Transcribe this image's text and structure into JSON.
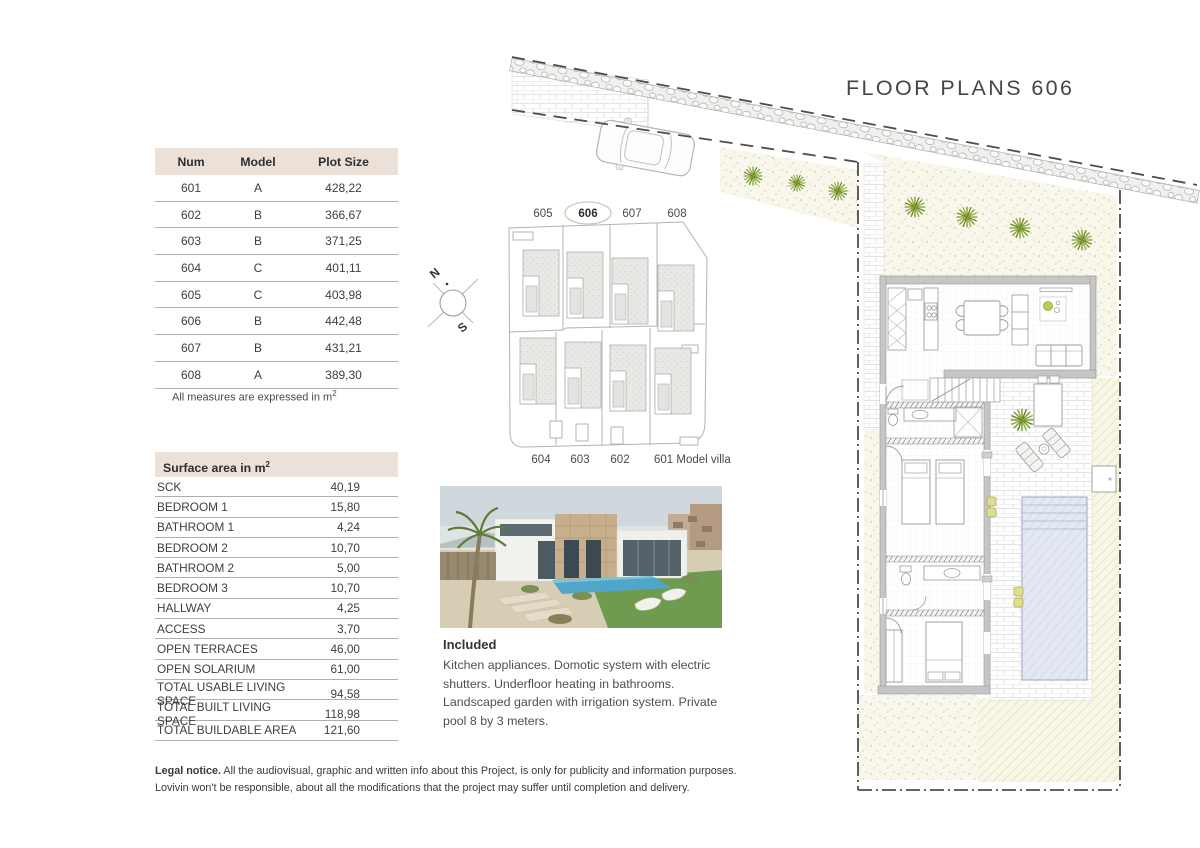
{
  "page": {
    "title": "FLOOR PLANS 606"
  },
  "plot_table": {
    "headers": [
      "Num",
      "Model",
      "Plot Size"
    ],
    "rows": [
      {
        "num": "601",
        "model": "A",
        "size": "428,22"
      },
      {
        "num": "602",
        "model": "B",
        "size": "366,67"
      },
      {
        "num": "603",
        "model": "B",
        "size": "371,25"
      },
      {
        "num": "604",
        "model": "C",
        "size": "401,11"
      },
      {
        "num": "605",
        "model": "C",
        "size": "403,98"
      },
      {
        "num": "606",
        "model": "B",
        "size": "442,48"
      },
      {
        "num": "607",
        "model": "B",
        "size": "431,21"
      },
      {
        "num": "608",
        "model": "A",
        "size": "389,30"
      }
    ],
    "note_text": "All measures are expressed in m",
    "note_sup": "2"
  },
  "surface_table": {
    "title_text": "Surface area in m",
    "title_sup": "2",
    "rows": [
      {
        "label": "SCK",
        "value": "40,19"
      },
      {
        "label": "BEDROOM 1",
        "value": "15,80"
      },
      {
        "label": "BATHROOM 1",
        "value": "4,24"
      },
      {
        "label": "BEDROOM 2",
        "value": "10,70"
      },
      {
        "label": "BATHROOM 2",
        "value": "5,00"
      },
      {
        "label": "BEDROOM 3",
        "value": "10,70"
      },
      {
        "label": "HALLWAY",
        "value": "4,25"
      },
      {
        "label": "ACCESS",
        "value": "3,70"
      },
      {
        "label": "OPEN TERRACES",
        "value": "46,00"
      },
      {
        "label": "OPEN SOLARIUM",
        "value": "61,00"
      },
      {
        "label": "TOTAL USABLE LIVING SPACE",
        "value": "94,58"
      },
      {
        "label": "TOTAL BUILT LIVING SPACE",
        "value": "118,98"
      },
      {
        "label": "TOTAL BUILDABLE AREA",
        "value": "121,60"
      }
    ]
  },
  "site_plan": {
    "top_labels": [
      "605",
      "606",
      "607",
      "608"
    ],
    "bottom_labels": [
      "604",
      "603",
      "602"
    ],
    "model_label": "601 Model villa",
    "highlighted": "606",
    "compass": {
      "north": "N",
      "south": "S"
    }
  },
  "included": {
    "title": "Included",
    "text": "Kitchen appliances. Domotic system with electric shutters. Underfloor heating in bathrooms. Landscaped garden with irrigation system. Private pool 8 by 3 meters."
  },
  "legal": {
    "bold": "Legal notice.",
    "line1": "All the audiovisual, graphic and written info about this Project, is only for publicity and information purposes.",
    "line2": "Lovivin won't be responsible, about all the modifications that the project may suffer until completion and delivery."
  },
  "colors": {
    "table_header_bg": "#ebe1d9",
    "table_line": "#b6ada5",
    "pool": "#e3e8f2",
    "sand": "#f9f7ec",
    "garden_hatch": "#f8f6e6",
    "plant_green": "#7d9b30",
    "boundary_dash": "#4d4d4d"
  }
}
